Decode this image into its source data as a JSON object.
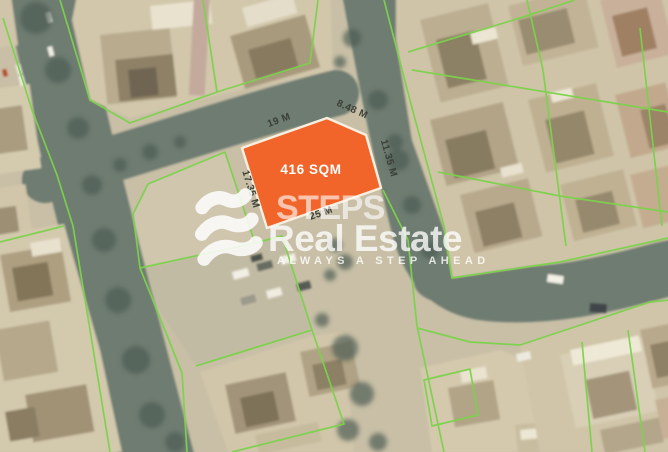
{
  "plot": {
    "area_label": "416 SQM",
    "dimensions": {
      "top": "19 M",
      "top_right": "8.48 M",
      "right": "11.35 M",
      "bottom": "25 M",
      "left": "17.35 M"
    },
    "fill_color": "#f2652a",
    "border_color": "#f7efdf"
  },
  "overlay": {
    "parcel_line_color": "#7cd24c",
    "dimension_label_color": "#3b3f36"
  },
  "watermark": {
    "brand_name": "STEPS",
    "brand_suffix": "Real Estate",
    "tagline": "ALWAYS A STEP AHEAD",
    "text_color": "#ffffff"
  }
}
